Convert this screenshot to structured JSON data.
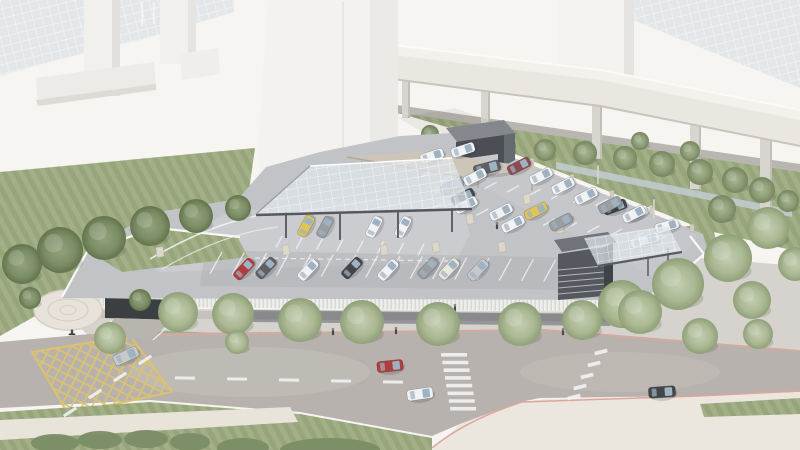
{
  "scene": {
    "description": "Aerial 3D architectural rendering of an elevated park-and-ride parking deck with glass drop-off canopy, ticket kiosk, exit toll building, elevated guideway, landscaped streets and circulating cars",
    "visible_text": "none"
  },
  "palette": {
    "bg": "#f6f5f2",
    "tile": "#e4e7ea",
    "tileLine": "#f2f4f6",
    "building": "#f1f0ed",
    "buildingShade": "#e2e0dc",
    "tower": "#f3f2ef",
    "towerShade": "#e9e7e3",
    "lawnA": "#a3b087",
    "lawnB": "#97a57b",
    "treeDark": "#7c8e66",
    "treeSage": "#b3bfa2",
    "treeMid": "#98a881",
    "viaduct": "#eae7e0",
    "viaductTop": "#f3f1eb",
    "pillar": "#d8d5cf",
    "road": "#b7b2ad",
    "roadLight": "#c8c3bd",
    "frontageRoad": "#b9b5b0",
    "deck": "#c2c3c7",
    "deckLight": "#d3d4d7",
    "deckDark": "#aeafb4",
    "fascia": "#ededeb",
    "sidewalk": "#d6d3ce",
    "storefront": "#797c80",
    "underpass": "#3c3f42",
    "plazaCream": "#ece7de",
    "sidewalkCream": "#e9e4da",
    "canal": "#c2ccd2",
    "kioskFront": "#4b4e54",
    "kioskSide": "#656a6f",
    "kioskRoof": "#84888d",
    "exitFront": "#55585e",
    "exitSide": "#3f4247",
    "exitRoof": "#70747a",
    "canopyBase": "#dfe5ea",
    "canopyEdge": "#55585c",
    "beigeCanopy": "#cdc6b8",
    "beigeCanopyEdge": "#b0a896",
    "fence": "#f8f8f7",
    "wallPost": "#d3cdc0",
    "block": "#ddd7cb",
    "hatchYellow": "#dcc26f",
    "curbPink": "#dfa59c",
    "lineWhite": "#f1f2f3",
    "glass": "#9fb2c2",
    "carWhite": "#f1f2f3",
    "carCream": "#e9e6da",
    "carSilver": "#c7cacd",
    "carGray": "#9a9ea2",
    "carDarkGray": "#5d6165",
    "carDark": "#42464a",
    "carRed": "#b23c3c",
    "carMaroon": "#8c4a55",
    "carYellow": "#e0c457"
  },
  "cars": [
    [
      126,
      356,
      -25,
      "carSilver",
      26,
      11
    ],
    [
      390,
      366,
      -6,
      "carRed",
      26,
      11
    ],
    [
      420,
      394,
      -8,
      "carWhite",
      26,
      11
    ],
    [
      662,
      392,
      -4,
      "carDark",
      27,
      11
    ],
    [
      645,
      240,
      -16,
      "carWhite",
      30,
      10
    ],
    [
      667,
      226,
      -16,
      "carWhite"
    ],
    [
      636,
      213,
      -20,
      "carWhite"
    ],
    [
      615,
      207,
      -20,
      "carDark"
    ],
    [
      432,
      156,
      -18,
      "carWhite"
    ],
    [
      463,
      150,
      -18,
      "carWhite"
    ],
    [
      487,
      168,
      -15,
      "carDarkGray",
      27,
      11
    ],
    [
      519,
      166,
      -27,
      "carMaroon"
    ],
    [
      541,
      176,
      -27,
      "carWhite"
    ],
    [
      563,
      186,
      -27,
      "carWhite"
    ],
    [
      586,
      196,
      -27,
      "carWhite"
    ],
    [
      610,
      205,
      -27,
      "carGray"
    ],
    [
      634,
      214,
      -27,
      "carWhite"
    ],
    [
      452,
      186,
      -27,
      "carGray"
    ],
    [
      475,
      177,
      -27,
      "carWhite"
    ],
    [
      463,
      197,
      -27,
      "carDark"
    ],
    [
      466,
      205,
      -27,
      "carWhite"
    ],
    [
      501,
      212,
      -27,
      "carWhite"
    ],
    [
      536,
      211,
      -27,
      "carYellow"
    ],
    [
      513,
      224,
      -27,
      "carWhite"
    ],
    [
      561,
      222,
      -27,
      "carGray"
    ],
    [
      244,
      269,
      -47,
      "carRed"
    ],
    [
      266,
      268,
      -47,
      "carDarkGray"
    ],
    [
      308,
      270,
      -47,
      "carWhite"
    ],
    [
      352,
      268,
      -47,
      "carDark"
    ],
    [
      388,
      270,
      -47,
      "carWhite"
    ],
    [
      428,
      268,
      -47,
      "carGray"
    ],
    [
      449,
      269,
      -47,
      "carCream"
    ],
    [
      478,
      270,
      -47,
      "carSilver"
    ],
    [
      306,
      226,
      -62,
      "carYellow",
      22,
      10
    ],
    [
      325,
      227,
      -62,
      "carGray",
      22,
      10
    ],
    [
      374,
      227,
      -62,
      "carWhite",
      22,
      10
    ],
    [
      403,
      227,
      -62,
      "carWhite",
      22,
      10
    ]
  ],
  "trees": {
    "street": [
      [
        178,
        312,
        20
      ],
      [
        233,
        314,
        21
      ],
      [
        300,
        320,
        22
      ],
      [
        362,
        322,
        22
      ],
      [
        438,
        324,
        22
      ],
      [
        520,
        324,
        22
      ],
      [
        582,
        320,
        20
      ],
      [
        640,
        312,
        22
      ],
      [
        700,
        336,
        18
      ],
      [
        758,
        334,
        15
      ],
      [
        110,
        338,
        16
      ],
      [
        237,
        342,
        12
      ]
    ],
    "right": [
      [
        622,
        304,
        24
      ],
      [
        678,
        284,
        26
      ],
      [
        728,
        258,
        24
      ],
      [
        768,
        228,
        21
      ],
      [
        795,
        264,
        17
      ],
      [
        752,
        300,
        19
      ]
    ],
    "lawn": [
      [
        22,
        264,
        20
      ],
      [
        60,
        250,
        23
      ],
      [
        104,
        238,
        22
      ],
      [
        150,
        226,
        20
      ],
      [
        196,
        216,
        17
      ],
      [
        238,
        208,
        13
      ],
      [
        30,
        298,
        11
      ],
      [
        140,
        300,
        11
      ]
    ],
    "strip": [
      [
        470,
        142,
        11
      ],
      [
        505,
        146,
        11
      ],
      [
        545,
        150,
        11
      ],
      [
        585,
        153,
        12
      ],
      [
        625,
        158,
        12
      ],
      [
        662,
        164,
        13
      ],
      [
        700,
        172,
        13
      ],
      [
        735,
        180,
        13
      ],
      [
        640,
        141,
        9
      ],
      [
        690,
        151,
        10
      ],
      [
        762,
        190,
        13
      ],
      [
        788,
        201,
        11
      ],
      [
        722,
        209,
        14
      ],
      [
        430,
        134,
        9
      ]
    ]
  },
  "people": [
    [
      290,
      331
    ],
    [
      333,
      333
    ],
    [
      373,
      331
    ],
    [
      396,
      332
    ],
    [
      452,
      337
    ],
    [
      523,
      335
    ],
    [
      563,
      333
    ],
    [
      497,
      227
    ],
    [
      455,
      309
    ],
    [
      240,
      337
    ],
    [
      610,
      305
    ]
  ],
  "cyclist": [
    72,
    333
  ],
  "blocks": [
    [
      437,
      190
    ],
    [
      470,
      219
    ],
    [
      502,
      247
    ],
    [
      384,
      250
    ],
    [
      160,
      252
    ],
    [
      286,
      250
    ],
    [
      527,
      199
    ],
    [
      560,
      228
    ],
    [
      592,
      256
    ],
    [
      436,
      247
    ]
  ],
  "wall_posts": [
    [
      452,
      130
    ],
    [
      492,
      146
    ],
    [
      532,
      162
    ],
    [
      572,
      178
    ],
    [
      612,
      194
    ],
    [
      652,
      211
    ],
    [
      692,
      228
    ]
  ],
  "light_poles": [
    [
      598,
      184
    ],
    [
      654,
      218
    ],
    [
      420,
      175
    ]
  ],
  "road_markings": {
    "crosswalk": {
      "x": 441,
      "y": 353,
      "count": 8,
      "step_x": 1.3,
      "step_y": 7.7,
      "bar_w": 26,
      "bar_h": 3.6
    },
    "yield_dashes": {
      "w": 13,
      "h": 3.8,
      "rot": -14,
      "pts": [
        [
          601,
          352
        ],
        [
          594,
          364
        ],
        [
          587,
          376
        ],
        [
          580,
          387
        ],
        [
          574,
          397
        ]
      ]
    },
    "lane_dashes": {
      "w": 20,
      "h": 3,
      "rot": 1,
      "pts": [
        [
          185,
          378
        ],
        [
          237,
          379
        ],
        [
          289,
          380
        ],
        [
          341,
          381
        ],
        [
          393,
          382
        ]
      ]
    },
    "diag_dashes": {
      "w": 15,
      "h": 3,
      "rot": -33,
      "pts": [
        [
          70,
          412
        ],
        [
          95,
          394
        ],
        [
          120,
          377
        ],
        [
          145,
          360
        ]
      ]
    },
    "deck_dashes": {
      "w": 4,
      "h": 8,
      "rot": 24,
      "pts": [
        [
          521,
          247
        ],
        [
          528,
          249
        ],
        [
          535,
          252
        ],
        [
          542,
          254
        ],
        [
          549,
          257
        ]
      ]
    },
    "stall_rows": [
      {
        "x1": 430,
        "y1": 172,
        "x2": 652,
        "y2": 206,
        "n": 11,
        "dx": -12,
        "dy": 6.5
      },
      {
        "x1": 444,
        "y1": 202,
        "x2": 666,
        "y2": 236,
        "n": 11,
        "dx": -12,
        "dy": 6.5
      },
      {
        "x1": 282,
        "y1": 236,
        "x2": 424,
        "y2": 244,
        "n": 8,
        "dx": -6,
        "dy": 11.5
      },
      {
        "x1": 222,
        "y1": 252,
        "x2": 578,
        "y2": 260,
        "n": 17,
        "dx": -12,
        "dy": 22
      }
    ]
  }
}
